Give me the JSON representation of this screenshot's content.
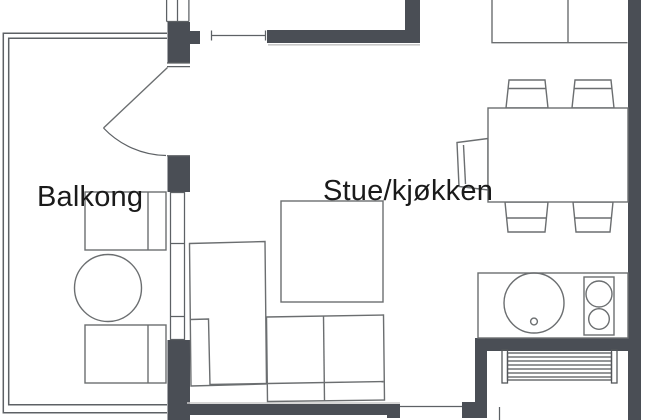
{
  "plan": {
    "rooms": {
      "balkong": {
        "label": "Balkong"
      },
      "stue_kjokken": {
        "label": "Stue/kjøkken"
      }
    },
    "fixtures": [
      "balcony-railing",
      "balcony-door-swing",
      "balcony-window",
      "top-window",
      "balcony-chair-upper",
      "balcony-chair-lower",
      "balcony-round-table",
      "dining-table",
      "dining-chair-top-left",
      "dining-chair-top-right",
      "dining-chair-bottom-left",
      "dining-chair-bottom-right",
      "dining-chair-side",
      "upper-cabinets",
      "kitchen-counter",
      "kitchen-sink",
      "cooktop-two-burner",
      "radiator",
      "sofa-sectional",
      "area-rug"
    ]
  },
  "colors": {
    "wall_fill": "#4a4e55",
    "furniture_line": "#6b6e70",
    "railing_line": "#5d6165",
    "window_line": "#5d6165",
    "radiator_line": "#54575b",
    "light_edge": "#c9c9c9",
    "text": "#1a1a1a",
    "background": "#ffffff"
  }
}
